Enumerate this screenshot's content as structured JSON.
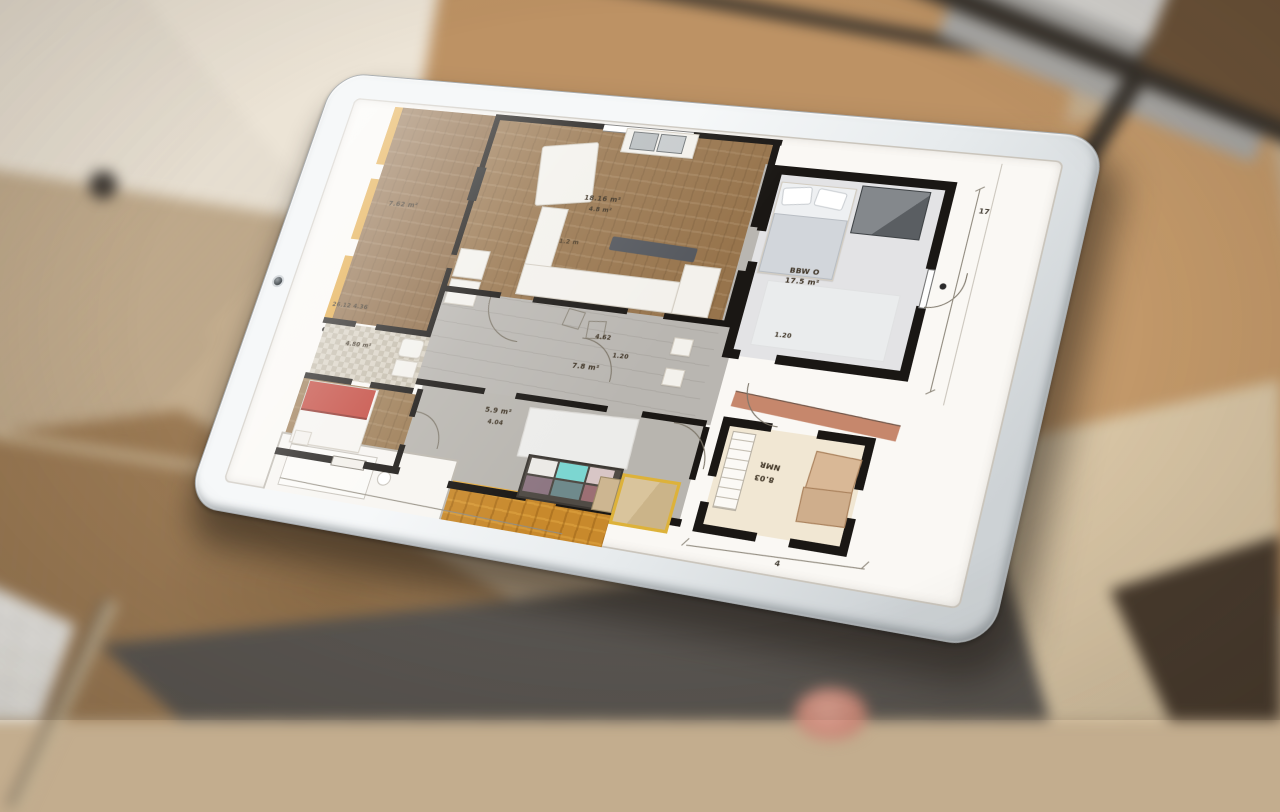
{
  "palette": {
    "bezel": "#edf0f1",
    "screen_bg": "#faf8f4",
    "wall_black": "#1a1714",
    "wood_floor": "#97744c",
    "accent_wall_orange": "#e2a63e",
    "orange_floor": "#c8892c",
    "hall_floor_gray": "#b9b6b1",
    "teal_panel": "#7cd6d1",
    "red_bed": "#c2453a",
    "cream_floor": "#f1e7d3",
    "bg_gray_plank": "#8e857a",
    "bg_oak_plank": "#c09566",
    "bg_brown_plank": "#9c7b55",
    "bg_cream_band": "#ece4d6",
    "bg_dark_walnut": "#473a2d"
  },
  "plan": {
    "labels": {
      "bedroom_left_area": "7.62 m²",
      "bedroom_left_note": "26.12 4.36",
      "living_area": "18.16 m²",
      "living_note": "4.8 m²",
      "sofa_note": "1.2 m",
      "bedroom_tr_name": "BBW O",
      "bedroom_tr_area": "17.5 m²",
      "bedroom_tr_note": "1.20",
      "hall_area": "7.8 m²",
      "hall_note_a": "4.62",
      "hall_note_b": "1.20",
      "bath_area": "4.80 m²",
      "kids_area": "5.9 m²",
      "kids_note": "4.04",
      "bedroom_br_name": "NMR",
      "bedroom_br_area": "8.03"
    },
    "dims": {
      "right": "17",
      "bottom": "4"
    }
  }
}
